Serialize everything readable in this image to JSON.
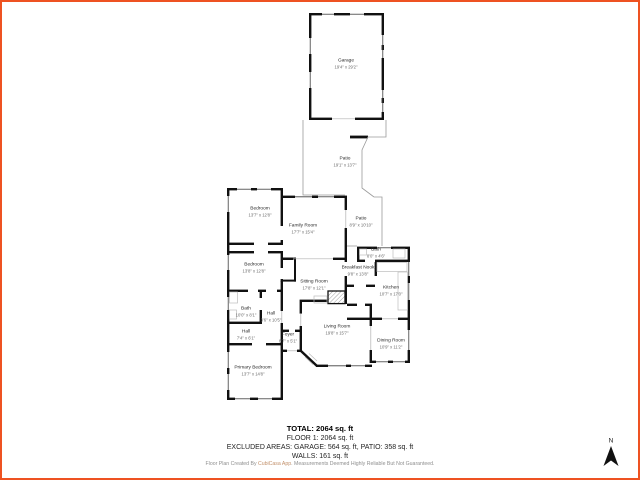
{
  "frame": {
    "border_color": "#ee5222"
  },
  "compass": {
    "label": "N"
  },
  "rooms": [
    {
      "name": "Garage",
      "dims": "19'4\" x 29'2\""
    },
    {
      "name": "Patio",
      "dims": "19'1\" x 13'7\""
    },
    {
      "name": "Bedroom",
      "dims": "13'7\" x 12'8\""
    },
    {
      "name": "Family Room",
      "dims": "17'7\" x 15'4\""
    },
    {
      "name": "Patio",
      "dims": "8'9\" x 10'10\""
    },
    {
      "name": "Bath",
      "dims": "8'0\" x 4'6\""
    },
    {
      "name": "Breakfast Nook",
      "dims": "9'8\" x 13'8\""
    },
    {
      "name": "Kitchen",
      "dims": "10'7\" x 17'0\""
    },
    {
      "name": "Sitting Room",
      "dims": "17'8\" x 12'1\""
    },
    {
      "name": "Bedroom",
      "dims": "13'8\" x 12'8\""
    },
    {
      "name": "Bath",
      "dims": "10'0\" x 8'1\""
    },
    {
      "name": "Hall",
      "dims": "3'6\" x 10'5\""
    },
    {
      "name": "Hall",
      "dims": "7'4\" x 6'1\""
    },
    {
      "name": "Foyer",
      "dims": "6'7\" x 5'1\""
    },
    {
      "name": "Primary Bedroom",
      "dims": "13'7\" x 14'8\""
    },
    {
      "name": "Living Room",
      "dims": "19'8\" x 15'7\""
    },
    {
      "name": "Dining Room",
      "dims": "10'9\" x 11'2\""
    }
  ],
  "summary": {
    "total": "TOTAL: 2064 sq. ft",
    "floor": "FLOOR 1: 2064 sq. ft",
    "excluded": "EXCLUDED AREAS: GARAGE: 564 sq. ft, PATIO: 358 sq. ft",
    "walls": "WALLS: 161 sq. ft"
  },
  "footer": {
    "disclaimer_pre": "Floor Plan Created By ",
    "disclaimer_brand": "CubiCasa App",
    "disclaimer_post": ". Measurements Deemed Highly Reliable But Not Guaranteed."
  }
}
